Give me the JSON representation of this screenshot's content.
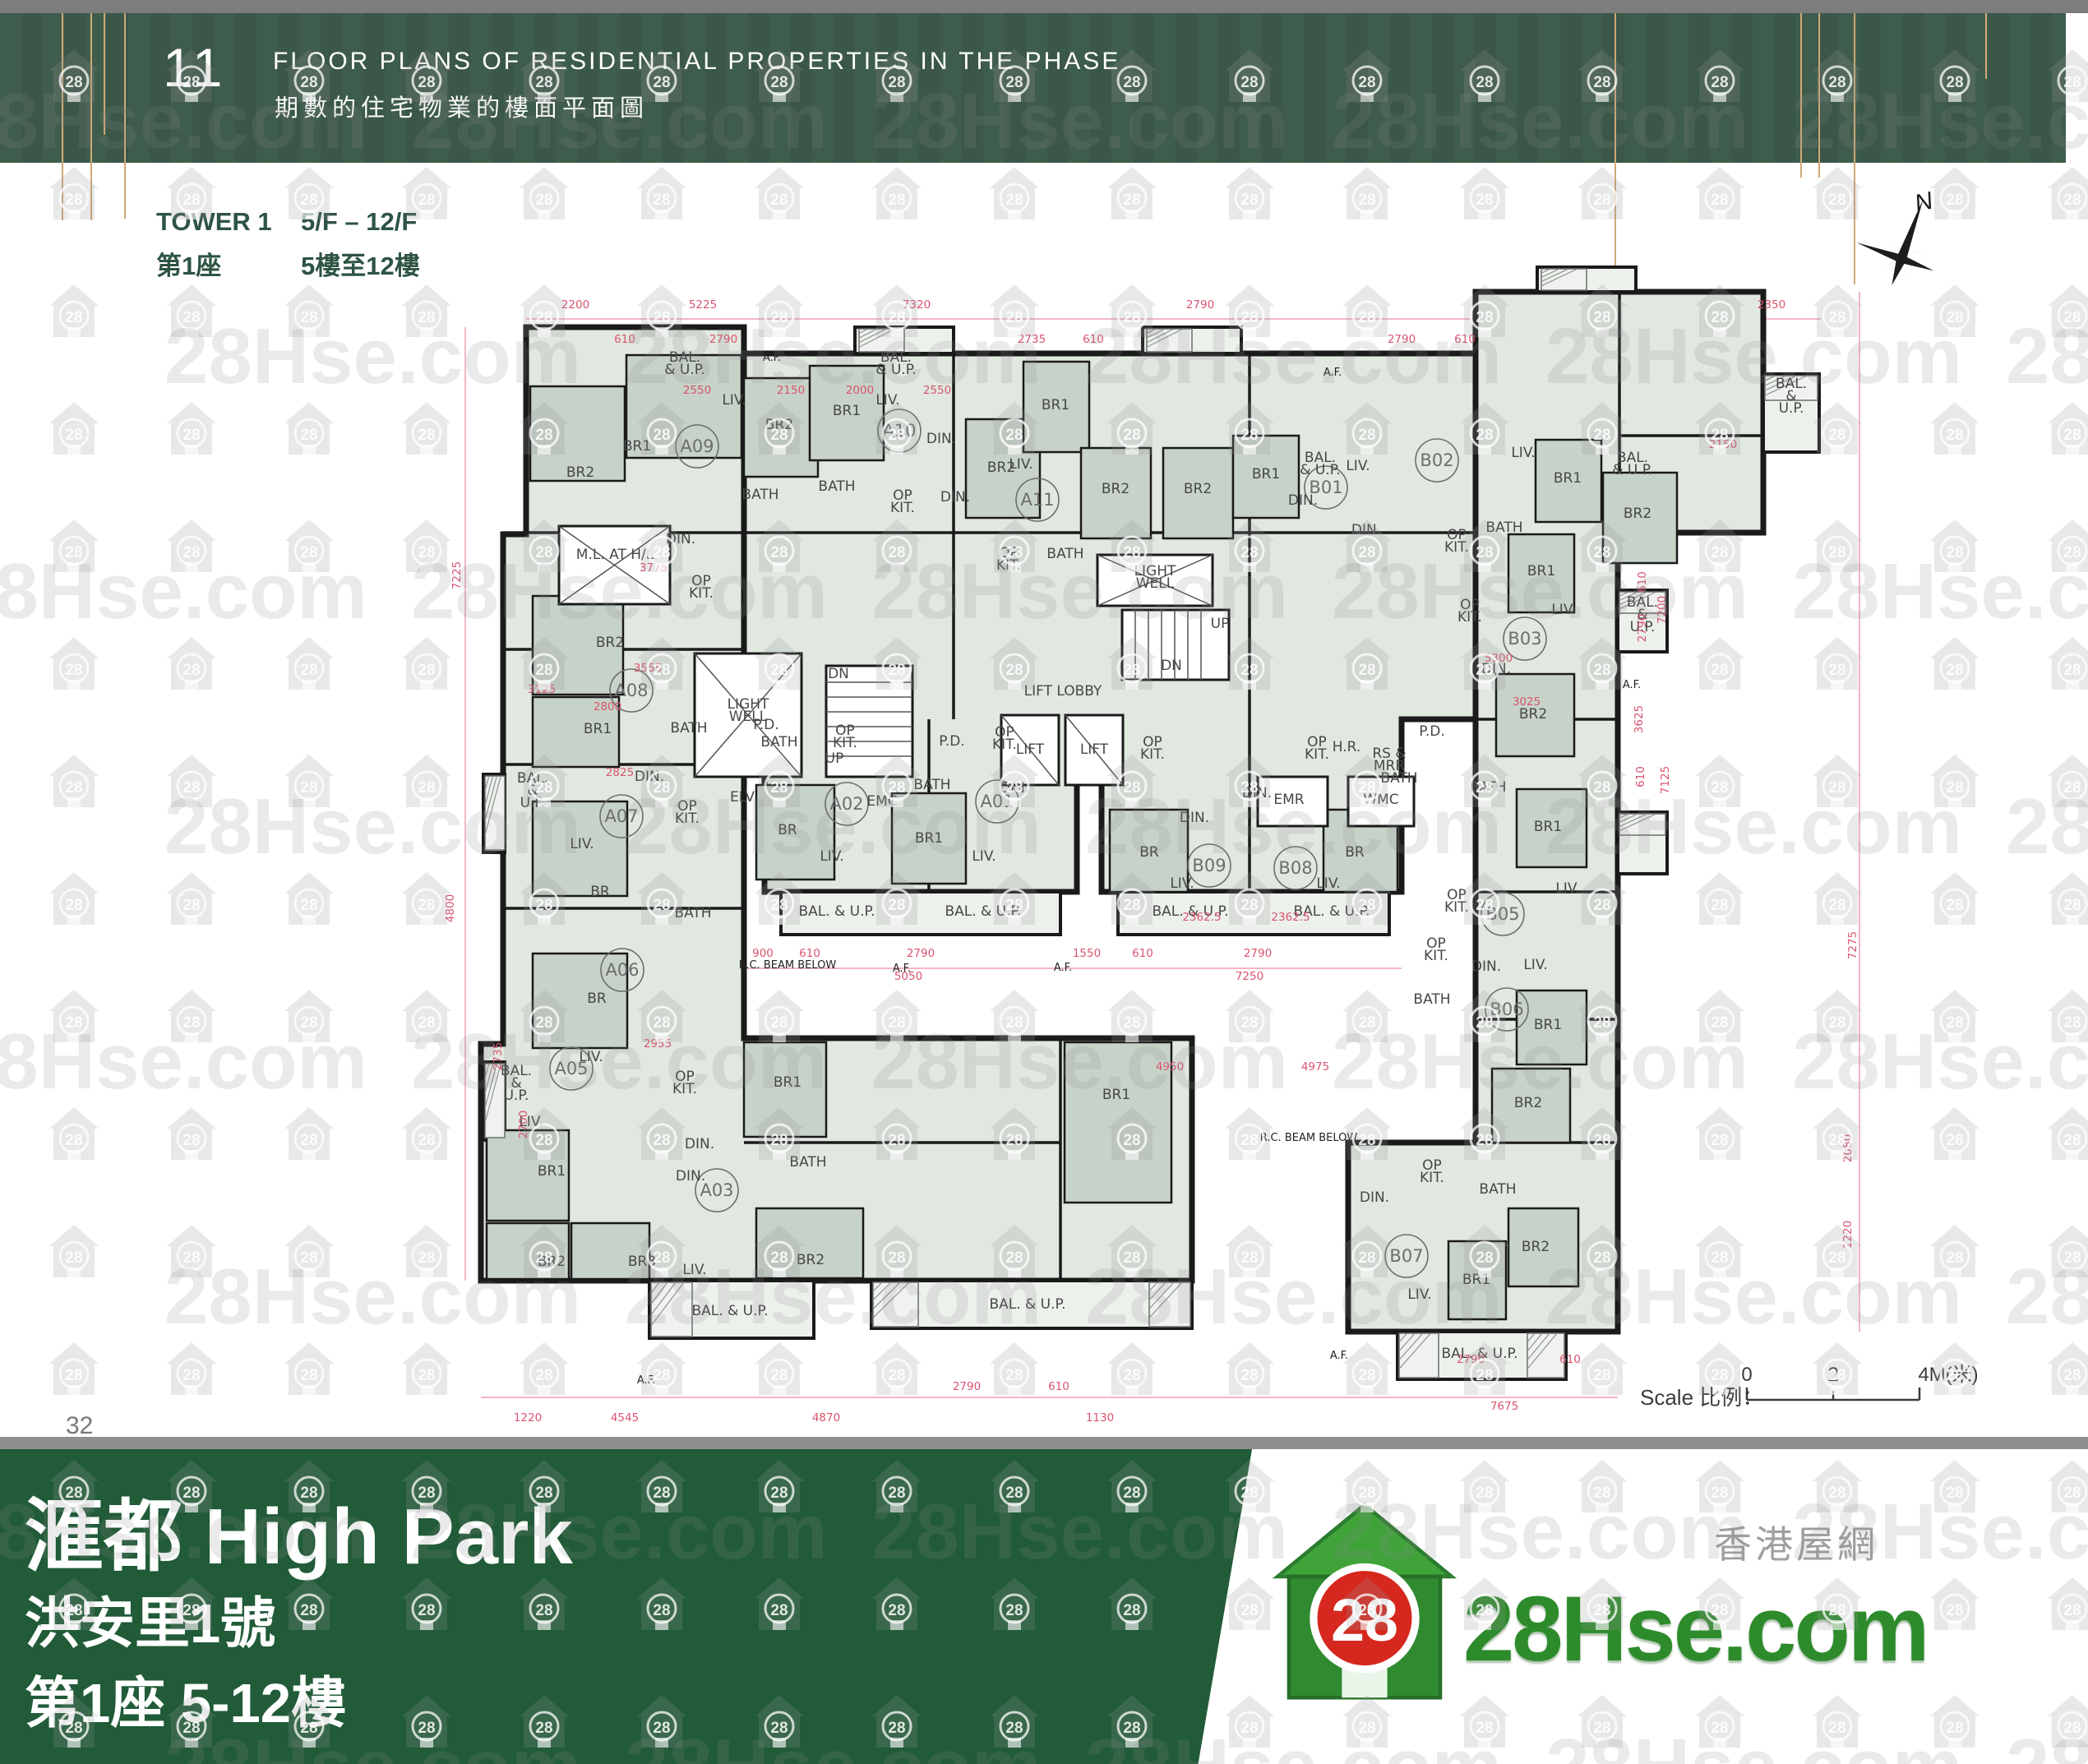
{
  "header": {
    "page_num": "11",
    "title_en": "FLOOR PLANS OF RESIDENTIAL PROPERTIES IN THE PHASE",
    "title_zh": "期數的住宅物業的樓面平面圖"
  },
  "tower_info": {
    "name_en": "TOWER 1",
    "floors_en": "5/F – 12/F",
    "name_zh": "第1座",
    "floors_zh": "5樓至12樓"
  },
  "compass": {
    "label": "N"
  },
  "scalebar": {
    "label": "Scale 比例：",
    "tick0": "0",
    "tick1": "2",
    "tick2": "4M(米)"
  },
  "page_number": "32",
  "footer": {
    "name": "滙都 High Park",
    "line2": "洪安里1號",
    "line3": "第1座 5-12樓"
  },
  "logo": {
    "badge": "28",
    "name": "28Hse.com",
    "tagline": "香港屋網"
  },
  "watermark": {
    "text": "28Hse.com",
    "badge": "28"
  },
  "colors": {
    "header_green": "#3f5d4c",
    "footer_green": "#215b38",
    "accent_gold": "#cfa878",
    "plan_fill": "#e1e8e0",
    "room_fill": "#c7d3c8",
    "wall": "#1a1a1a",
    "dim_pink": "#d9546f",
    "logo_green": "#2e8b2c",
    "logo_red": "#d6281e",
    "text_green": "#2e5443"
  },
  "plan": {
    "unit_labels": [
      [
        "A01",
        1213,
        975
      ],
      [
        "A02",
        1030,
        978
      ],
      [
        "A03",
        872,
        1448
      ],
      [
        "A05",
        695,
        1300
      ],
      [
        "A06",
        757,
        1180
      ],
      [
        "A07",
        756,
        993
      ],
      [
        "A08",
        768,
        840
      ],
      [
        "A09",
        848,
        543
      ],
      [
        "A10",
        1094,
        524
      ],
      [
        "A11",
        1262,
        608
      ],
      [
        "B01",
        1613,
        593
      ],
      [
        "B02",
        1748,
        560
      ],
      [
        "B03",
        1855,
        777
      ],
      [
        "B05",
        1828,
        1112
      ],
      [
        "B06",
        1833,
        1228
      ],
      [
        "B07",
        1711,
        1528
      ],
      [
        "B08",
        1576,
        1056
      ],
      [
        "B09",
        1471,
        1053
      ]
    ],
    "room_labels": [
      [
        "BAL.\n& U.P.",
        833,
        440,
        14
      ],
      [
        "BAL.\n& U.P.",
        1090,
        440,
        14
      ],
      [
        "BAL.\n& U.P.",
        1606,
        562,
        14
      ],
      [
        "BAL.\n& U.P.",
        1986,
        562,
        14
      ],
      [
        "BAL.\n&\nU.P.",
        2179,
        472,
        13
      ],
      [
        "BAL.\n&\nU.P.",
        1998,
        738,
        13
      ],
      [
        "BAL.\n&\nU.P.",
        648,
        952,
        13
      ],
      [
        "BAL.\n&\nU.P.",
        628,
        1308,
        13
      ],
      [
        "BAL. & U.P.",
        888,
        1600,
        14
      ],
      [
        "BAL. & U.P.",
        1250,
        1592,
        14
      ],
      [
        "BAL. & U.P.",
        1800,
        1652,
        14
      ],
      [
        "BAL. & U.P.",
        1018,
        1114,
        14
      ],
      [
        "BAL. & U.P.",
        1196,
        1114,
        14
      ],
      [
        "BAL. & U.P.",
        1448,
        1114,
        14
      ],
      [
        "BAL. & U.P.",
        1620,
        1114,
        14
      ],
      [
        "BR1",
        775,
        548
      ],
      [
        "BR2",
        706,
        580
      ],
      [
        "BR2",
        948,
        522
      ],
      [
        "BR1",
        1030,
        505
      ],
      [
        "BR2",
        1218,
        574
      ],
      [
        "BR1",
        1284,
        498
      ],
      [
        "BR2",
        1357,
        600
      ],
      [
        "BR2",
        1457,
        600
      ],
      [
        "BR1",
        1540,
        582
      ],
      [
        "LIV.",
        893,
        492
      ],
      [
        "LIV.",
        1080,
        492
      ],
      [
        "LIV.",
        1242,
        570
      ],
      [
        "LIV.",
        1652,
        572
      ],
      [
        "DIN.",
        1585,
        614
      ],
      [
        "DIN.",
        828,
        661
      ],
      [
        "DIN.",
        1145,
        539
      ],
      [
        "DIN.",
        1162,
        610
      ],
      [
        "OP\nKIT.",
        853,
        712
      ],
      [
        "OP\nKIT.",
        1098,
        608
      ],
      [
        "OP\nKIT.",
        1227,
        678
      ],
      [
        "BATH",
        925,
        607,
        14
      ],
      [
        "BATH",
        1018,
        597,
        14
      ],
      [
        "BATH",
        1296,
        679,
        14
      ],
      [
        "BR2",
        742,
        787
      ],
      [
        "BR1",
        727,
        892
      ],
      [
        "BATH",
        838,
        891,
        14
      ],
      [
        "DIN.",
        790,
        950
      ],
      [
        "LIV.",
        708,
        1032
      ],
      [
        "BR",
        730,
        1090
      ],
      [
        "OP\nKIT.",
        836,
        986
      ],
      [
        "BATH",
        843,
        1116,
        14
      ],
      [
        "BR",
        726,
        1220
      ],
      [
        "LIV.",
        719,
        1291
      ],
      [
        "OP\nKIT.",
        833,
        1315
      ],
      [
        "DIN.",
        851,
        1397
      ],
      [
        "LIV.",
        646,
        1370
      ],
      [
        "BR1",
        671,
        1430
      ],
      [
        "BR2",
        671,
        1540
      ],
      [
        "BR3",
        781,
        1540
      ],
      [
        "DIN.",
        840,
        1436
      ],
      [
        "LIV.",
        845,
        1550
      ],
      [
        "BR1",
        958,
        1322
      ],
      [
        "BATH",
        983,
        1419,
        14
      ],
      [
        "BR2",
        986,
        1538
      ],
      [
        "BR1",
        1358,
        1337
      ],
      [
        "BR",
        958,
        1015
      ],
      [
        "LIV.",
        1012,
        1047
      ],
      [
        "OP\nKIT.",
        1028,
        894
      ],
      [
        "BATH",
        948,
        908,
        14
      ],
      [
        "BR1",
        1130,
        1025
      ],
      [
        "LIV.",
        1197,
        1047
      ],
      [
        "DIN.",
        1234,
        964
      ],
      [
        "OP\nKIT.",
        1222,
        896
      ],
      [
        "BATH",
        1134,
        960,
        14
      ],
      [
        "BR",
        1398,
        1042
      ],
      [
        "LIV.",
        1438,
        1080
      ],
      [
        "DIN.",
        1453,
        1000
      ],
      [
        "OP\nKIT.",
        1402,
        908
      ],
      [
        "BR",
        1648,
        1042
      ],
      [
        "LIV.",
        1616,
        1080
      ],
      [
        "DIN.",
        1529,
        970
      ],
      [
        "OP\nKIT.",
        1602,
        908
      ],
      [
        "BATH",
        1702,
        952,
        14
      ],
      [
        "DIN.",
        1662,
        650
      ],
      [
        "LIV.",
        1853,
        556
      ],
      [
        "BR1",
        1907,
        587
      ],
      [
        "BR2",
        1992,
        630
      ],
      [
        "BATH",
        1830,
        647,
        14
      ],
      [
        "OP\nKIT.",
        1772,
        656
      ],
      [
        "BR1",
        1875,
        700
      ],
      [
        "LIV.",
        1902,
        747
      ],
      [
        "DIN.",
        1820,
        819
      ],
      [
        "OP\nKIT.",
        1788,
        741
      ],
      [
        "BR2",
        1865,
        874
      ],
      [
        "BR1",
        1883,
        1011
      ],
      [
        "LIV.",
        1907,
        1086
      ],
      [
        "DIN.",
        1808,
        1181
      ],
      [
        "OP\nKIT.",
        1772,
        1094
      ],
      [
        "BATH",
        1810,
        963,
        14
      ],
      [
        "BR1",
        1883,
        1252
      ],
      [
        "BR2",
        1859,
        1347
      ],
      [
        "LIV.",
        1868,
        1179
      ],
      [
        "OP\nKIT.",
        1747,
        1153
      ],
      [
        "BATH",
        1742,
        1221,
        14
      ],
      [
        "DIN.",
        1672,
        1462
      ],
      [
        "LIV.",
        1727,
        1580
      ],
      [
        "BR1",
        1796,
        1562
      ],
      [
        "BR2",
        1868,
        1522
      ],
      [
        "OP\nKIT.",
        1742,
        1423
      ],
      [
        "BATH",
        1822,
        1452,
        14
      ],
      [
        "LIGHT\nWELL",
        910,
        862,
        13
      ],
      [
        "LIGHT\nWELL",
        1405,
        700,
        13
      ],
      [
        "M.L. AT H/L",
        748,
        680,
        12
      ],
      [
        "LIFT",
        1253,
        917,
        14
      ],
      [
        "LIFT",
        1331,
        917,
        14
      ],
      [
        "LIFT LOBBY",
        1293,
        846,
        13
      ],
      [
        "EMR",
        1568,
        978,
        13
      ],
      [
        "WMC",
        1680,
        978,
        13
      ],
      [
        "RS &\nMRR",
        1690,
        922,
        12
      ],
      [
        "ELV",
        903,
        975,
        13
      ],
      [
        "EMC",
        1073,
        980,
        13
      ],
      [
        "P.D.",
        932,
        887,
        11
      ],
      [
        "P.D.",
        1158,
        907,
        11
      ],
      [
        "P.D.",
        1742,
        895,
        11
      ],
      [
        "H.R.",
        1638,
        914,
        11
      ],
      [
        "DN",
        1020,
        825,
        12
      ],
      [
        "UP",
        1015,
        928,
        12
      ],
      [
        "UP",
        1484,
        764,
        12
      ],
      [
        "DN",
        1425,
        815,
        12
      ]
    ],
    "annotations": [
      [
        "A.F.",
        939,
        439
      ],
      [
        "A.F.",
        1621,
        457
      ],
      [
        "A.F.",
        1097,
        1182
      ],
      [
        "A.F.",
        1293,
        1181
      ],
      [
        "A.F.",
        1985,
        837
      ],
      [
        "A.F.",
        1629,
        1653
      ],
      [
        "A.F.",
        786,
        1683
      ],
      [
        "R.C. BEAM BELOW",
        958,
        1178
      ],
      [
        "R.C. BEAM BELOW",
        1592,
        1388
      ]
    ],
    "dims": [
      [
        "2200",
        700,
        375
      ],
      [
        "5225",
        855,
        375
      ],
      [
        "7320",
        1115,
        375
      ],
      [
        "2790",
        1460,
        375
      ],
      [
        "2350",
        2155,
        375
      ],
      [
        "610",
        760,
        417
      ],
      [
        "2790",
        880,
        417
      ],
      [
        "2735",
        1255,
        417
      ],
      [
        "610",
        1330,
        417
      ],
      [
        "2790",
        1705,
        417
      ],
      [
        "610",
        1782,
        417
      ],
      [
        "2550",
        848,
        479
      ],
      [
        "2150",
        962,
        479
      ],
      [
        "2000",
        1046,
        479
      ],
      [
        "2550",
        1140,
        479
      ],
      [
        "3775",
        795,
        695
      ],
      [
        "3125",
        659,
        843
      ],
      [
        "2800",
        739,
        864
      ],
      [
        "2825",
        754,
        944
      ],
      [
        "3555",
        788,
        817
      ],
      [
        "2955",
        800,
        1274
      ],
      [
        "7225",
        560,
        700,
        1
      ],
      [
        "4800",
        552,
        1105,
        1
      ],
      [
        "2735",
        610,
        1285,
        1
      ],
      [
        "2700",
        641,
        1368,
        1
      ],
      [
        "900",
        928,
        1164
      ],
      [
        "610",
        985,
        1164
      ],
      [
        "2790",
        1120,
        1164
      ],
      [
        "1550",
        1322,
        1164
      ],
      [
        "610",
        1390,
        1164
      ],
      [
        "2790",
        1530,
        1164
      ],
      [
        "5050",
        1105,
        1192
      ],
      [
        "7250",
        1520,
        1192
      ],
      [
        "4950",
        1423,
        1302
      ],
      [
        "4975",
        1600,
        1302
      ],
      [
        "2362.5",
        1462,
        1120,
        0,
        11
      ],
      [
        "2362.5",
        1570,
        1120,
        0,
        11
      ],
      [
        "5300",
        1823,
        805
      ],
      [
        "3025",
        1857,
        858
      ],
      [
        "2150",
        2096,
        545
      ],
      [
        "610",
        2002,
        708,
        1
      ],
      [
        "2790",
        2002,
        764,
        1
      ],
      [
        "3625",
        1998,
        875,
        1
      ],
      [
        "610",
        2000,
        945,
        1
      ],
      [
        "7200",
        2026,
        742,
        1
      ],
      [
        "7125",
        2030,
        949,
        1
      ],
      [
        "7275",
        2258,
        1150,
        1
      ],
      [
        "2080",
        2252,
        1397,
        1
      ],
      [
        "1220",
        2252,
        1502,
        1
      ],
      [
        "2790",
        1176,
        1691
      ],
      [
        "610",
        1288,
        1691
      ],
      [
        "1220",
        642,
        1729
      ],
      [
        "4545",
        760,
        1729
      ],
      [
        "4870",
        1005,
        1729
      ],
      [
        "1130",
        1338,
        1729
      ],
      [
        "2790",
        1789,
        1658
      ],
      [
        "610",
        1910,
        1658
      ],
      [
        "7675",
        1830,
        1715
      ]
    ]
  }
}
